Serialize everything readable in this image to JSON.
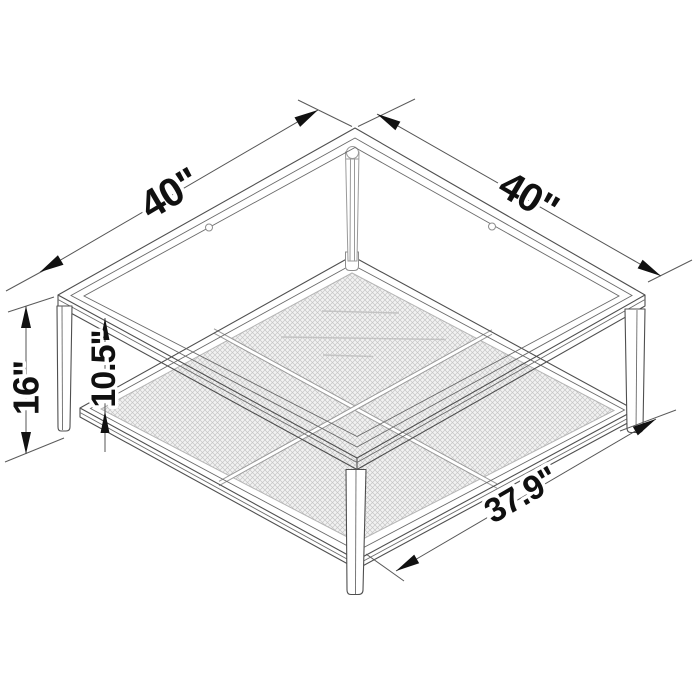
{
  "diagram": {
    "labels": {
      "top_left_edge": "40\"",
      "top_right_edge": "40\"",
      "overall_height": "16\"",
      "shelf_clearance": "10.5\"",
      "shelf_width": "37.9\""
    },
    "colors": {
      "background": "#ffffff",
      "line": "#4f4f4f",
      "dimension_text": "#101010"
    }
  }
}
